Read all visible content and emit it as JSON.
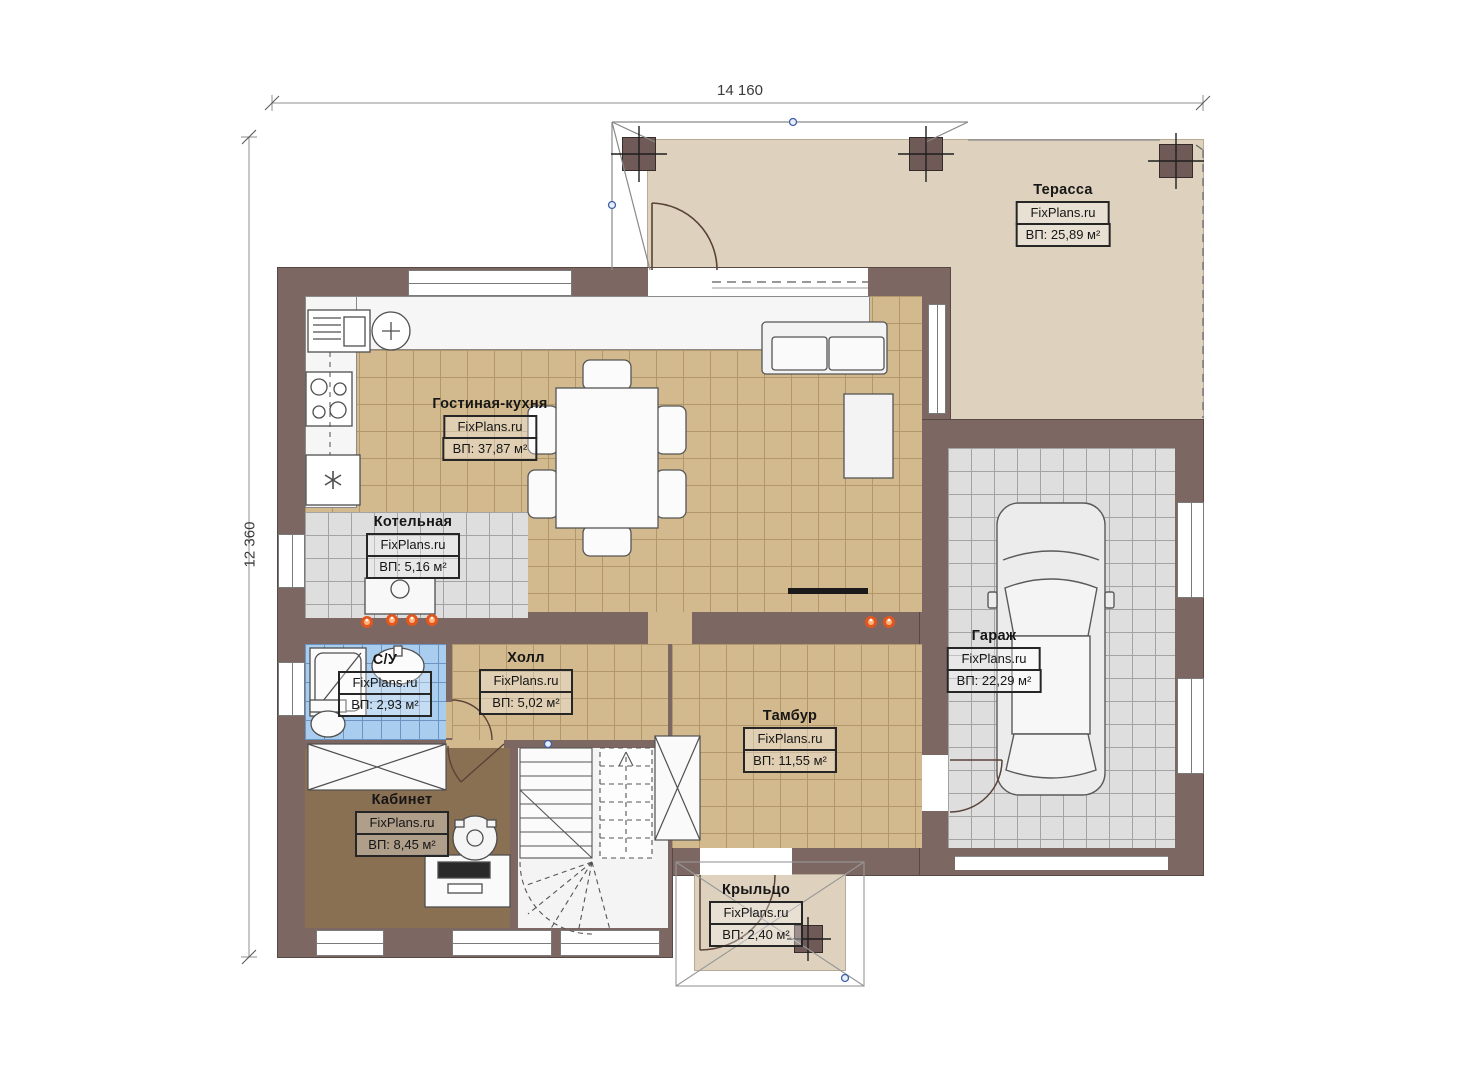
{
  "plan": {
    "title": "first-floor-plan",
    "brand": "FixPlans.ru"
  },
  "dimensions": {
    "width_label": "14 160",
    "height_label": "12 360"
  },
  "rooms": [
    {
      "id": "terrace",
      "name": "Терасса",
      "brand": "FixPlans.ru",
      "area": "ВП: 25,89 м²"
    },
    {
      "id": "living-kitchen",
      "name": "Гостиная-кухня",
      "brand": "FixPlans.ru",
      "area": "ВП: 37,87 м²"
    },
    {
      "id": "boiler-room",
      "name": "Котельная",
      "brand": "FixPlans.ru",
      "area": "ВП: 5,16 м²"
    },
    {
      "id": "bathroom",
      "name": "С/У",
      "brand": "FixPlans.ru",
      "area": "ВП: 2,93 м²"
    },
    {
      "id": "hall",
      "name": "Холл",
      "brand": "FixPlans.ru",
      "area": "ВП: 5,02 м²"
    },
    {
      "id": "vestibule",
      "name": "Тамбур",
      "brand": "FixPlans.ru",
      "area": "ВП: 11,55 м²"
    },
    {
      "id": "garage",
      "name": "Гараж",
      "brand": "FixPlans.ru",
      "area": "ВП: 22,29 м²"
    },
    {
      "id": "office",
      "name": "Кабинет",
      "brand": "FixPlans.ru",
      "area": "ВП: 8,45 м²"
    },
    {
      "id": "porch",
      "name": "Крыльцо",
      "brand": "FixPlans.ru",
      "area": "ВП: 2,40 м²"
    }
  ],
  "colors": {
    "wall": "#7d6763",
    "floor_tan": "#d2b98e",
    "floor_gray": "#dedede",
    "floor_blue": "#a9cdee",
    "floor_beige": "#ded2bf",
    "floor_office": "#8a7053",
    "radiator": "#e2571f",
    "node_blue": "#3f61a8"
  }
}
